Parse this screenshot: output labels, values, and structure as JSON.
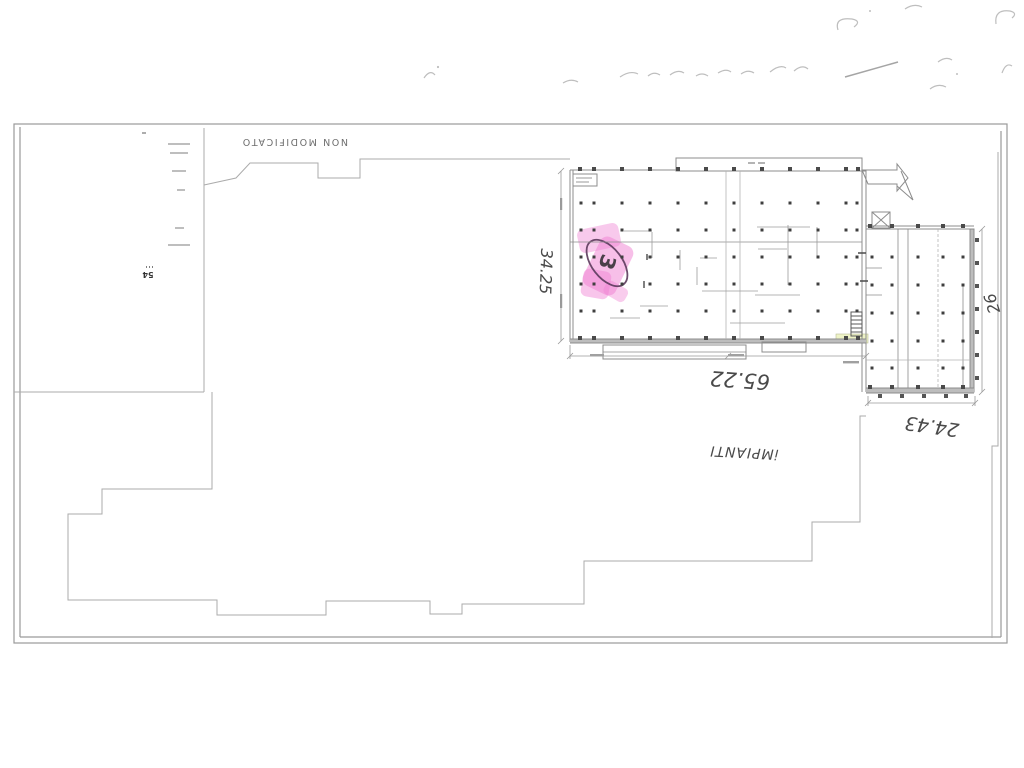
{
  "scan": {
    "stamp_text": "NON MODIFICATO",
    "legend_number": "54",
    "circled_number": "3",
    "dimensions": {
      "left_vertical": "34.25",
      "bottom": "65.22",
      "bottom_right": "24.43",
      "right_vertical": "26"
    },
    "note": "iMPIANTI"
  },
  "colors": {
    "highlight_pink": "#ef7fd2",
    "pen_plum": "#5c3a5c",
    "highlight_yellow": "#eef3c6",
    "wall_gray": "#8c8c8c",
    "wall_fill": "#bdbdbd",
    "boundary_gray": "#ababab",
    "frame_gray": "#9a9a9a",
    "column_dot": "#3f3f3f",
    "ghost_ink": "#b3b3b3",
    "detail_gray": "#9c9c9c"
  },
  "plan_grid": {
    "hall": {
      "cols": [
        581,
        594,
        622,
        650,
        678,
        706,
        734,
        762,
        790,
        818,
        846,
        857
      ],
      "rows": [
        203,
        230,
        257,
        284,
        311
      ]
    },
    "wing": {
      "cols": [
        872,
        892,
        918,
        943,
        963
      ],
      "rows": [
        257,
        285,
        313,
        341,
        368
      ]
    },
    "hall_wall_xs": [
      580,
      594,
      622,
      650,
      678,
      706,
      734,
      762,
      790,
      818,
      846,
      858
    ],
    "hall_wall_rows": [
      169,
      338
    ],
    "wing_wall_xs": [
      870,
      892,
      918,
      943,
      963
    ],
    "wing_wall_rows": [
      226,
      387
    ],
    "right_tick_ys": [
      240,
      263,
      286,
      309,
      332,
      355,
      378
    ],
    "bottom_tick_xs": [
      880,
      902,
      924,
      946,
      966
    ]
  }
}
